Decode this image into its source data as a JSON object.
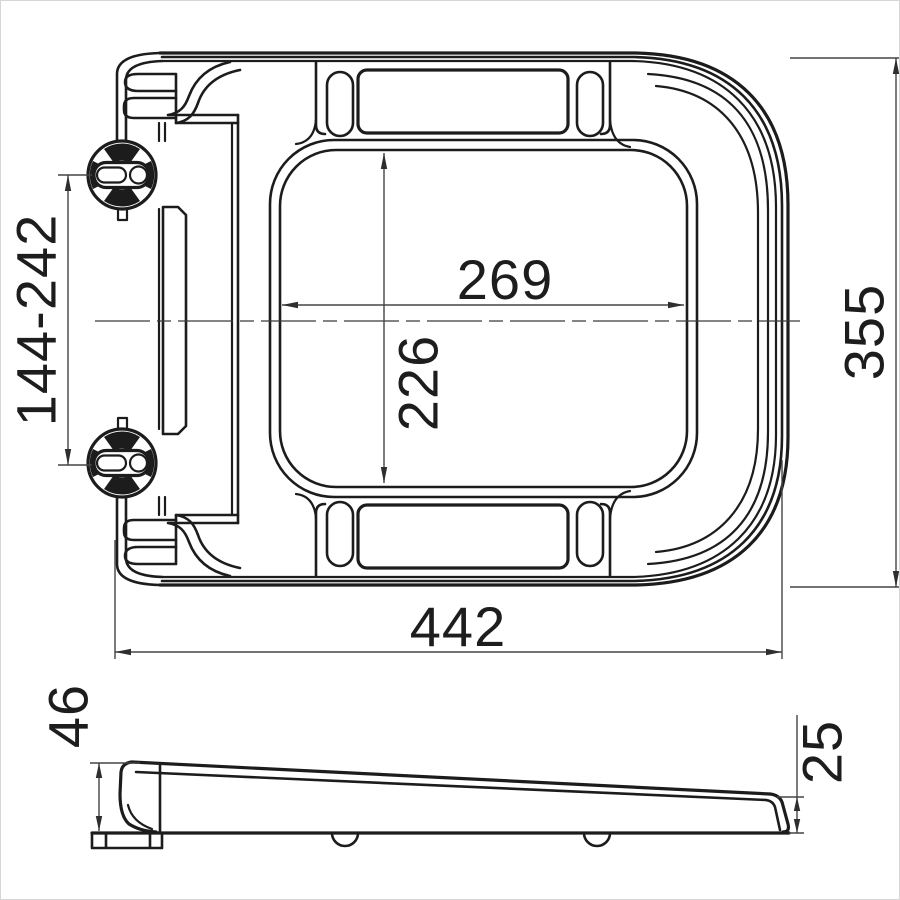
{
  "drawing": {
    "title": "toilet-seat-technical-drawing",
    "background_color": "#ffffff",
    "line_color": "#1c1c1c",
    "dimension_color": "#454545",
    "views": {
      "top_view": "seat-plan-view",
      "side_view": "seat-profile-view"
    },
    "dimensions": {
      "hinge_hole_spacing": "144-242",
      "inner_cutout_width": "269",
      "inner_cutout_depth": "226",
      "overall_depth": "355",
      "overall_width": "442",
      "rear_height": "46",
      "front_height": "25"
    }
  }
}
